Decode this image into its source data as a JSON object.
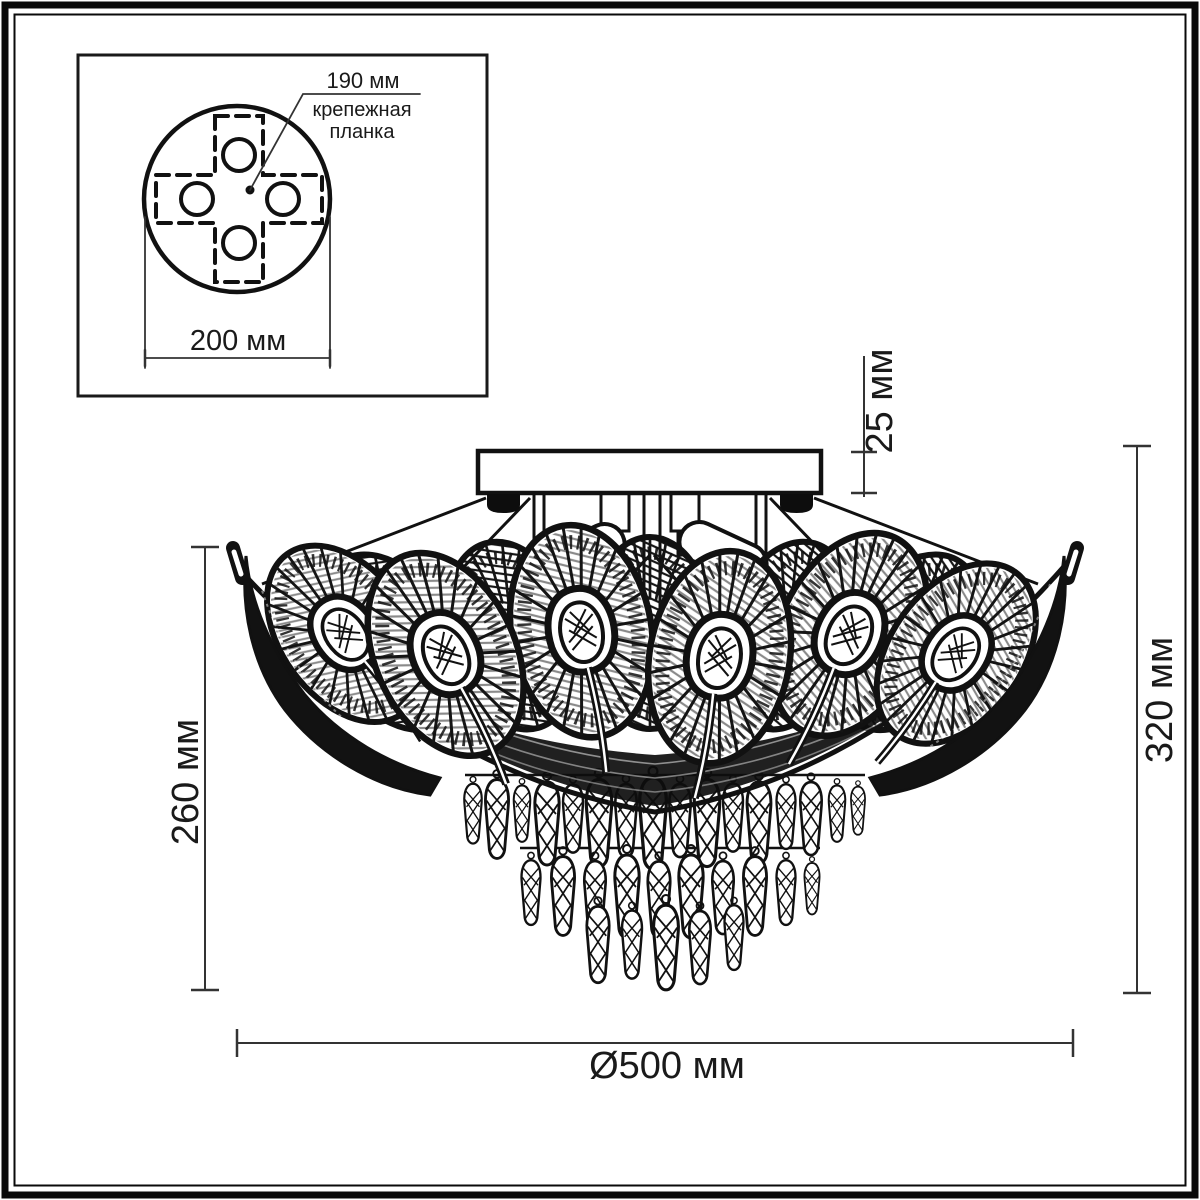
{
  "colors": {
    "ink": "#1a1a1a",
    "dim_line": "#3a3a3a",
    "background": "#ffffff"
  },
  "inset": {
    "hole_pitch": "190 мм",
    "bracket_line1": "крепежная",
    "bracket_line2": "планка",
    "plate_diameter": "200 мм"
  },
  "dimensions": {
    "canopy_height": "25 мм",
    "shade_height": "260 мм",
    "total_height": "320 мм",
    "diameter": "Ø500 мм"
  }
}
